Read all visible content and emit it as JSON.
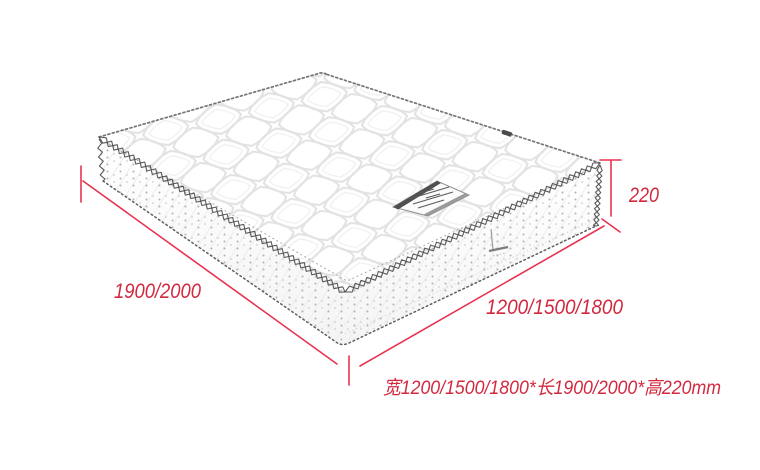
{
  "diagram": {
    "kind": "mattress-dimension-diagram",
    "labels": {
      "height": "220",
      "length": "1900/2000",
      "width": "1200/1500/1800",
      "spec": "宽1200/1500/1800*长1900/2000*高220mm"
    },
    "colors": {
      "dimension_line": "#e73350",
      "dimension_text": "#d2293f",
      "artwork_line": "#5f5f5f",
      "background": "#ffffff"
    }
  }
}
